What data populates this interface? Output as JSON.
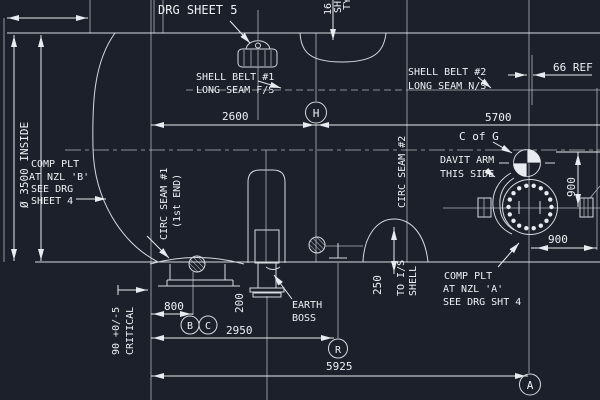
{
  "drawing": {
    "title_note": "DRG SHEET 5",
    "notes": {
      "shell_belt_1": [
        "SHELL BELT #1",
        "LONG SEAM F/S"
      ],
      "shell_belt_2": [
        "SHELL BELT #2",
        "LONG SEAM N/S"
      ],
      "comp_plt_b": [
        "COMP PLT",
        "AT NZL 'B'",
        "SEE DRG",
        "SHEET 4"
      ],
      "comp_plt_a": [
        "COMP PLT",
        "AT NZL 'A'",
        "SEE DRG SHT 4"
      ],
      "davit_arm": [
        "DAVIT ARM",
        "THIS SIDE"
      ],
      "c_of_g": "C of G",
      "earth_boss": [
        "EARTH",
        "BOSS"
      ],
      "circ_seam_1": [
        "CIRC SEAM #1",
        "(1st END)"
      ],
      "circ_seam_2": "CIRC SEAM #2",
      "to_is_shell": [
        "TO I/S",
        "SHELL"
      ],
      "thk_note": [
        "16 THK",
        "SHELL",
        "TYP"
      ]
    },
    "dimensions": {
      "dia_inside": "Ø 3500 INSIDE",
      "d2600": "2600",
      "d5700": "5700",
      "d66ref": "66 REF",
      "d900_vert": "900",
      "d900_horiz": "900",
      "d250": "250",
      "d800": "800",
      "d200": "200",
      "d2950": "2950",
      "d5925": "5925",
      "d90": "90 +0/-5",
      "critical": "CRITICAL"
    },
    "markers": {
      "h": "H",
      "b": "B",
      "c": "C",
      "r": "R",
      "a": "A"
    },
    "colors": {
      "background": "#1c202a",
      "line": "#d6dae0",
      "text": "#eef1f5",
      "accent_white": "#e8ebef"
    }
  }
}
